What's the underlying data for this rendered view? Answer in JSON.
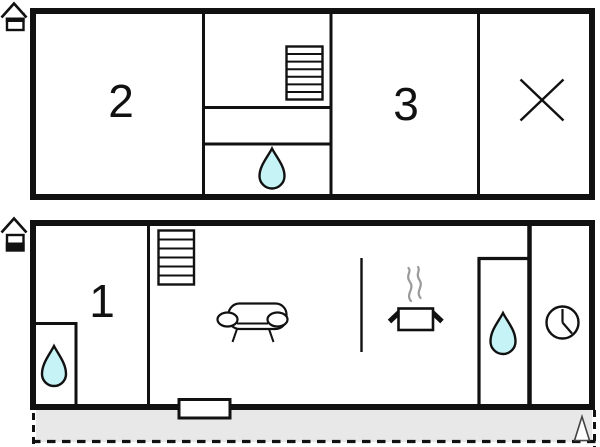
{
  "colors": {
    "wall": "#111111",
    "water_fill": "#c6f3f5",
    "terrace_fill": "#e8e8e8",
    "steam": "#9a9a9a"
  },
  "upper_floor": {
    "rooms": [
      {
        "label": "2"
      },
      {
        "label": "3"
      }
    ],
    "icons": [
      "home-upper-floor-icon",
      "staircase-icon",
      "water-drop-icon",
      "cross-icon"
    ]
  },
  "ground_floor": {
    "rooms": [
      {
        "label": "1"
      }
    ],
    "icons": [
      "home-ground-floor-icon",
      "staircase-icon",
      "water-drop-icon",
      "sofa-icon",
      "cooking-pot-icon",
      "clock-icon",
      "window-icon",
      "entrance-triangle-icon",
      "terrace-area"
    ]
  }
}
